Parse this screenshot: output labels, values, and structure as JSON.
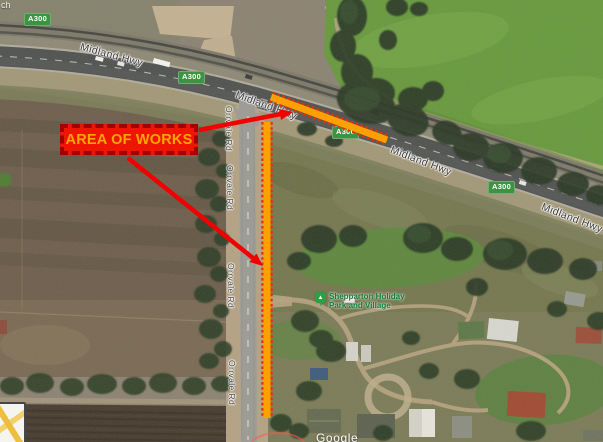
{
  "map": {
    "type": "satellite",
    "watermark": "Google",
    "corner_partial_text": "ch",
    "highway": {
      "shield": "A300",
      "name": "Midland Hwy"
    },
    "side_road": {
      "name": "Orrvale Rd"
    },
    "poi": {
      "name_line1": "Shepparton Holiday",
      "name_line2": "Park and Village"
    }
  },
  "annotations": {
    "area_of_works": {
      "label": "AREA OF WORKS"
    },
    "colors": {
      "callout_fill": "#ee1600",
      "callout_border": "#a30000",
      "callout_text": "#ffa600",
      "works_line_core": "#ffa000",
      "works_line_dash": "#e83000",
      "arrow": "#f20000",
      "shield_green": "#3f9243",
      "poi_green": "#157a38"
    }
  }
}
